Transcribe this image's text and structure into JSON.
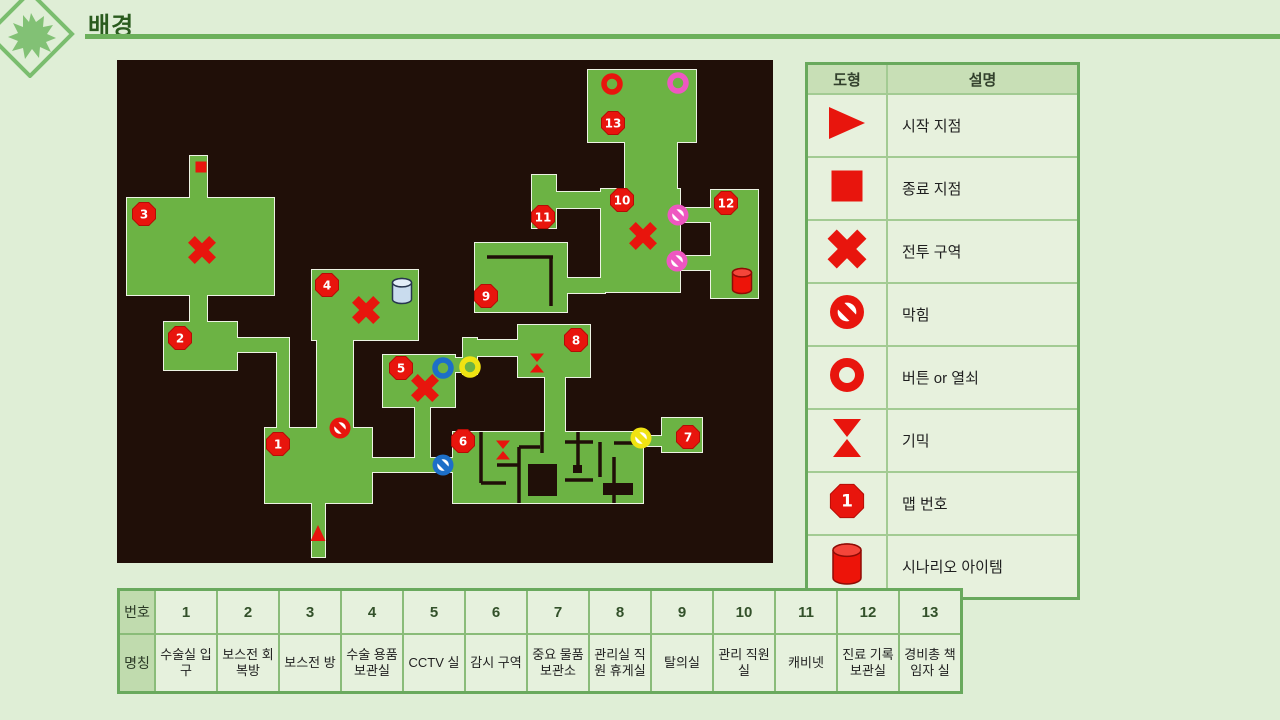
{
  "page": {
    "title": "배경"
  },
  "palette": {
    "red": "#e8150d",
    "red_dark": "#b50d06",
    "pink": "#ee57c1",
    "blue": "#1d6fc8",
    "yellow": "#f0e312",
    "accent_green": "#6cb05b",
    "logo_green": "#82c175"
  },
  "legend": {
    "headers": {
      "shape": "도형",
      "desc": "설명"
    },
    "rows": [
      {
        "icon": "start-triangle-icon",
        "label": "시작 지점"
      },
      {
        "icon": "end-square-icon",
        "label": "종료 지점"
      },
      {
        "icon": "battle-x-icon",
        "label": "전투 구역"
      },
      {
        "icon": "blocked-icon",
        "label": "막힘"
      },
      {
        "icon": "button-key-ring-icon",
        "label": "버튼 or 열쇠"
      },
      {
        "icon": "gimmick-hourglass-icon",
        "label": "기믹"
      },
      {
        "icon": "map-number-octagon-icon",
        "label": "맵 번호",
        "badge": "1"
      },
      {
        "icon": "scenario-item-cylinder-icon",
        "label": "시나리오 아이템"
      }
    ]
  },
  "rooms_table": {
    "row_headers": [
      "번호",
      "명칭"
    ],
    "numbers": [
      "1",
      "2",
      "3",
      "4",
      "5",
      "6",
      "7",
      "8",
      "9",
      "10",
      "11",
      "12",
      "13"
    ],
    "names": [
      "수술실 입구",
      "보스전 회복방",
      "보스전 방",
      "수술 용품 보관실",
      "CCTV 실",
      "감시 구역",
      "중요 물품 보관소",
      "관리실 직원 휴게실",
      "탈의실",
      "관리 직원실",
      "캐비넷",
      "진료 기록 보관실",
      "경비총 책임자 실"
    ]
  },
  "map": {
    "bg": "#200f08",
    "room_fill": "#6cb344",
    "room_stroke": "#edf3e4",
    "w": 656,
    "h": 503,
    "rooms": [
      {
        "x": 73,
        "y": 96,
        "w": 17,
        "h": 46
      },
      {
        "x": 10,
        "y": 138,
        "w": 147,
        "h": 97
      },
      {
        "x": 73,
        "y": 231,
        "w": 17,
        "h": 35
      },
      {
        "x": 47,
        "y": 262,
        "w": 73,
        "h": 48
      },
      {
        "x": 116,
        "y": 278,
        "w": 56,
        "h": 14
      },
      {
        "x": 160,
        "y": 288,
        "w": 12,
        "h": 84
      },
      {
        "x": 148,
        "y": 368,
        "w": 107,
        "h": 75
      },
      {
        "x": 195,
        "y": 439,
        "w": 13,
        "h": 58
      },
      {
        "x": 251,
        "y": 398,
        "w": 89,
        "h": 14
      },
      {
        "x": 195,
        "y": 210,
        "w": 106,
        "h": 70
      },
      {
        "x": 200,
        "y": 276,
        "w": 36,
        "h": 94
      },
      {
        "x": 266,
        "y": 295,
        "w": 72,
        "h": 52
      },
      {
        "x": 298,
        "y": 343,
        "w": 15,
        "h": 62
      },
      {
        "x": 334,
        "y": 298,
        "w": 22,
        "h": 14
      },
      {
        "x": 346,
        "y": 278,
        "w": 14,
        "h": 36
      },
      {
        "x": 352,
        "y": 280,
        "w": 52,
        "h": 16
      },
      {
        "x": 401,
        "y": 265,
        "w": 72,
        "h": 52
      },
      {
        "x": 428,
        "y": 313,
        "w": 20,
        "h": 62
      },
      {
        "x": 336,
        "y": 372,
        "w": 190,
        "h": 71
      },
      {
        "x": 522,
        "y": 376,
        "w": 27,
        "h": 10
      },
      {
        "x": 545,
        "y": 358,
        "w": 40,
        "h": 34
      },
      {
        "x": 358,
        "y": 183,
        "w": 92,
        "h": 69
      },
      {
        "x": 446,
        "y": 218,
        "w": 42,
        "h": 15
      },
      {
        "x": 484,
        "y": 129,
        "w": 79,
        "h": 103
      },
      {
        "x": 415,
        "y": 115,
        "w": 24,
        "h": 53
      },
      {
        "x": 435,
        "y": 132,
        "w": 53,
        "h": 16
      },
      {
        "x": 508,
        "y": 78,
        "w": 52,
        "h": 55
      },
      {
        "x": 471,
        "y": 10,
        "w": 108,
        "h": 72
      },
      {
        "x": 560,
        "y": 148,
        "w": 38,
        "h": 14
      },
      {
        "x": 560,
        "y": 196,
        "w": 38,
        "h": 14
      },
      {
        "x": 594,
        "y": 130,
        "w": 47,
        "h": 108
      }
    ],
    "walls": [
      {
        "x1": 370,
        "y1": 197,
        "x2": 436,
        "y2": 197
      },
      {
        "x1": 434,
        "y1": 197,
        "x2": 434,
        "y2": 246
      },
      {
        "x1": 364,
        "y1": 372,
        "x2": 364,
        "y2": 423
      },
      {
        "x1": 364,
        "y1": 423,
        "x2": 389,
        "y2": 423
      },
      {
        "x1": 402,
        "y1": 387,
        "x2": 402,
        "y2": 443
      },
      {
        "x1": 380,
        "y1": 405,
        "x2": 402,
        "y2": 405
      },
      {
        "x1": 402,
        "y1": 387,
        "x2": 423,
        "y2": 387
      },
      {
        "x1": 425,
        "y1": 372,
        "x2": 425,
        "y2": 393
      },
      {
        "x1": 448,
        "y1": 382,
        "x2": 476,
        "y2": 382
      },
      {
        "x1": 461,
        "y1": 372,
        "x2": 461,
        "y2": 405
      },
      {
        "x1": 448,
        "y1": 420,
        "x2": 476,
        "y2": 420
      },
      {
        "x1": 483,
        "y1": 382,
        "x2": 483,
        "y2": 417
      },
      {
        "x1": 497,
        "y1": 397,
        "x2": 497,
        "y2": 443
      },
      {
        "x1": 497,
        "y1": 383,
        "x2": 526,
        "y2": 383
      }
    ],
    "blocks": [
      {
        "x": 411,
        "y": 404,
        "w": 29,
        "h": 32
      },
      {
        "x": 456,
        "y": 405,
        "w": 9,
        "h": 8
      },
      {
        "x": 486,
        "y": 423,
        "w": 30,
        "h": 12
      }
    ],
    "icons": [
      {
        "type": "square",
        "x": 84,
        "y": 107,
        "color": "red",
        "name": "end-square-icon"
      },
      {
        "type": "tri-up",
        "x": 201,
        "y": 473,
        "color": "red",
        "name": "start-triangle-icon"
      },
      {
        "type": "x",
        "x": 85,
        "y": 190,
        "color": "red",
        "name": "battle-x-icon"
      },
      {
        "type": "x",
        "x": 249,
        "y": 250,
        "color": "red",
        "name": "battle-x-icon"
      },
      {
        "type": "x",
        "x": 308,
        "y": 328,
        "color": "red",
        "name": "battle-x-icon"
      },
      {
        "type": "x",
        "x": 526,
        "y": 176,
        "color": "red",
        "name": "battle-x-icon"
      },
      {
        "type": "noentry",
        "x": 223,
        "y": 368,
        "color": "red",
        "name": "blocked-icon"
      },
      {
        "type": "noentry",
        "x": 561,
        "y": 155,
        "color": "pink",
        "name": "blocked-icon"
      },
      {
        "type": "noentry",
        "x": 560,
        "y": 201,
        "color": "pink",
        "name": "blocked-icon"
      },
      {
        "type": "noentry",
        "x": 326,
        "y": 405,
        "color": "blue",
        "name": "blocked-icon"
      },
      {
        "type": "noentry",
        "x": 524,
        "y": 378,
        "color": "yellow",
        "name": "blocked-icon"
      },
      {
        "type": "ring",
        "x": 495,
        "y": 24,
        "color": "red",
        "name": "button-key-ring-icon"
      },
      {
        "type": "ring",
        "x": 561,
        "y": 23,
        "color": "pink",
        "name": "button-key-ring-icon"
      },
      {
        "type": "ring",
        "x": 326,
        "y": 308,
        "color": "blue",
        "name": "button-key-ring-icon"
      },
      {
        "type": "ring",
        "x": 353,
        "y": 307,
        "color": "yellow",
        "name": "button-key-ring-icon"
      },
      {
        "type": "hourglass",
        "x": 420,
        "y": 303,
        "color": "red",
        "name": "gimmick-hourglass-icon"
      },
      {
        "type": "hourglass",
        "x": 386,
        "y": 390,
        "color": "red",
        "name": "gimmick-hourglass-icon"
      },
      {
        "type": "cylinder",
        "x": 285,
        "y": 231,
        "variant": "silver",
        "name": "scenario-item-cylinder-icon"
      },
      {
        "type": "cylinder",
        "x": 625,
        "y": 221,
        "variant": "red",
        "name": "scenario-item-cylinder-icon"
      },
      {
        "type": "badge",
        "x": 161,
        "y": 384,
        "n": "1"
      },
      {
        "type": "badge",
        "x": 63,
        "y": 278,
        "n": "2"
      },
      {
        "type": "badge",
        "x": 27,
        "y": 154,
        "n": "3"
      },
      {
        "type": "badge",
        "x": 210,
        "y": 225,
        "n": "4"
      },
      {
        "type": "badge",
        "x": 284,
        "y": 308,
        "n": "5"
      },
      {
        "type": "badge",
        "x": 346,
        "y": 381,
        "n": "6"
      },
      {
        "type": "badge",
        "x": 571,
        "y": 377,
        "n": "7"
      },
      {
        "type": "badge",
        "x": 459,
        "y": 280,
        "n": "8"
      },
      {
        "type": "badge",
        "x": 369,
        "y": 236,
        "n": "9"
      },
      {
        "type": "badge",
        "x": 505,
        "y": 140,
        "n": "10"
      },
      {
        "type": "badge",
        "x": 426,
        "y": 157,
        "n": "11"
      },
      {
        "type": "badge",
        "x": 609,
        "y": 143,
        "n": "12"
      },
      {
        "type": "badge",
        "x": 496,
        "y": 63,
        "n": "13"
      }
    ]
  }
}
